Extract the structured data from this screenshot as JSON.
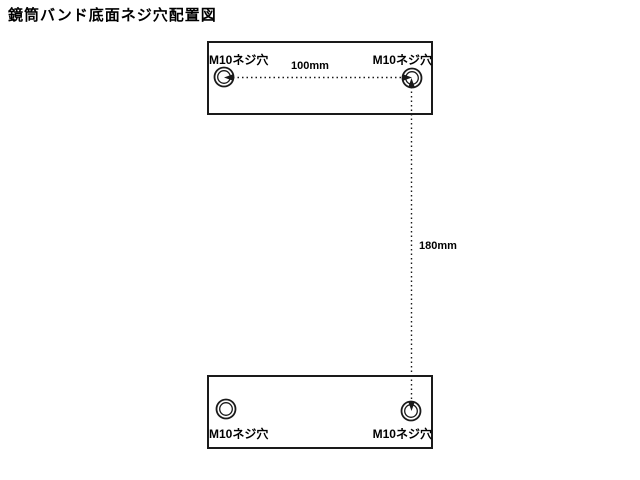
{
  "title": "鏡筒バンド底面ネジ穴配置図",
  "colors": {
    "background": "#ffffff",
    "line": "#1a1a1a",
    "text": "#000000"
  },
  "diagram": {
    "plates": {
      "top": "top-band-plate",
      "bottom": "bottom-band-plate"
    },
    "holes": {
      "top_left": "M10ネジ穴",
      "top_right": "M10ネジ穴",
      "bottom_left": "M10ネジ穴",
      "bottom_right": "M10ネジ穴"
    },
    "dimensions": {
      "horizontal": "100mm",
      "vertical": "180mm"
    }
  }
}
